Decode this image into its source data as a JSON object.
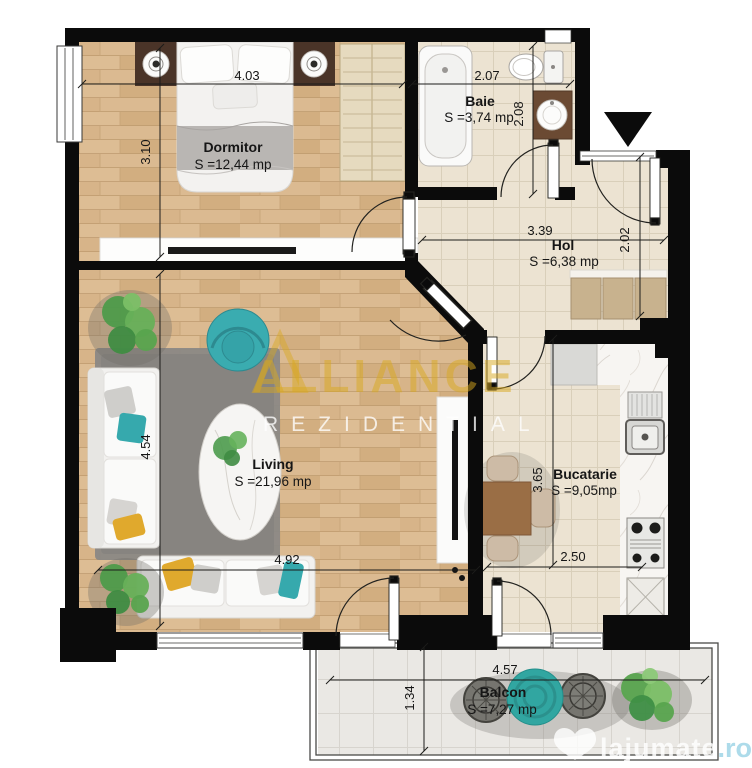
{
  "title": "Apartment floor plan",
  "watermark": {
    "brand": "ALLIANCE",
    "brand_sub": "REZIDENTIAL",
    "site_name": "lajumate",
    "site_tld": ".ro"
  },
  "rooms": [
    {
      "id": "dormitor",
      "name": "Dormitor",
      "area": "S =12,44 mp",
      "width": "4.03",
      "height": "3.10"
    },
    {
      "id": "baie",
      "name": "Baie",
      "area": "S =3,74 mp",
      "width": "2.07",
      "height": "2.08"
    },
    {
      "id": "hol",
      "name": "Hol",
      "area": "S =6,38 mp",
      "width": "3.39",
      "height": "2.02"
    },
    {
      "id": "living",
      "name": "Living",
      "area": "S =21,96 mp",
      "width": "4.92",
      "height": "4.54"
    },
    {
      "id": "bucatarie",
      "name": "Bucatarie",
      "area": "S =9,05mp",
      "width": "2.50",
      "height": "3.65"
    },
    {
      "id": "balcon",
      "name": "Balcon",
      "area": "S =7,27 mp",
      "width": "4.57",
      "height": "1.34"
    }
  ],
  "colors": {
    "wall": "#0b0b0b",
    "wood": "#d8b78c",
    "tile": "#ece3d2",
    "balcony_tile": "#eae8e4",
    "marble": "#f7f5f2",
    "accent_teal": "#36a9ad",
    "accent_yellow": "#e0a92d",
    "brand_gold": "#d9a91f",
    "site_blue": "#a9dae9",
    "closet_tan": "#c8b28e",
    "vanity_brown": "#6b4a33"
  }
}
